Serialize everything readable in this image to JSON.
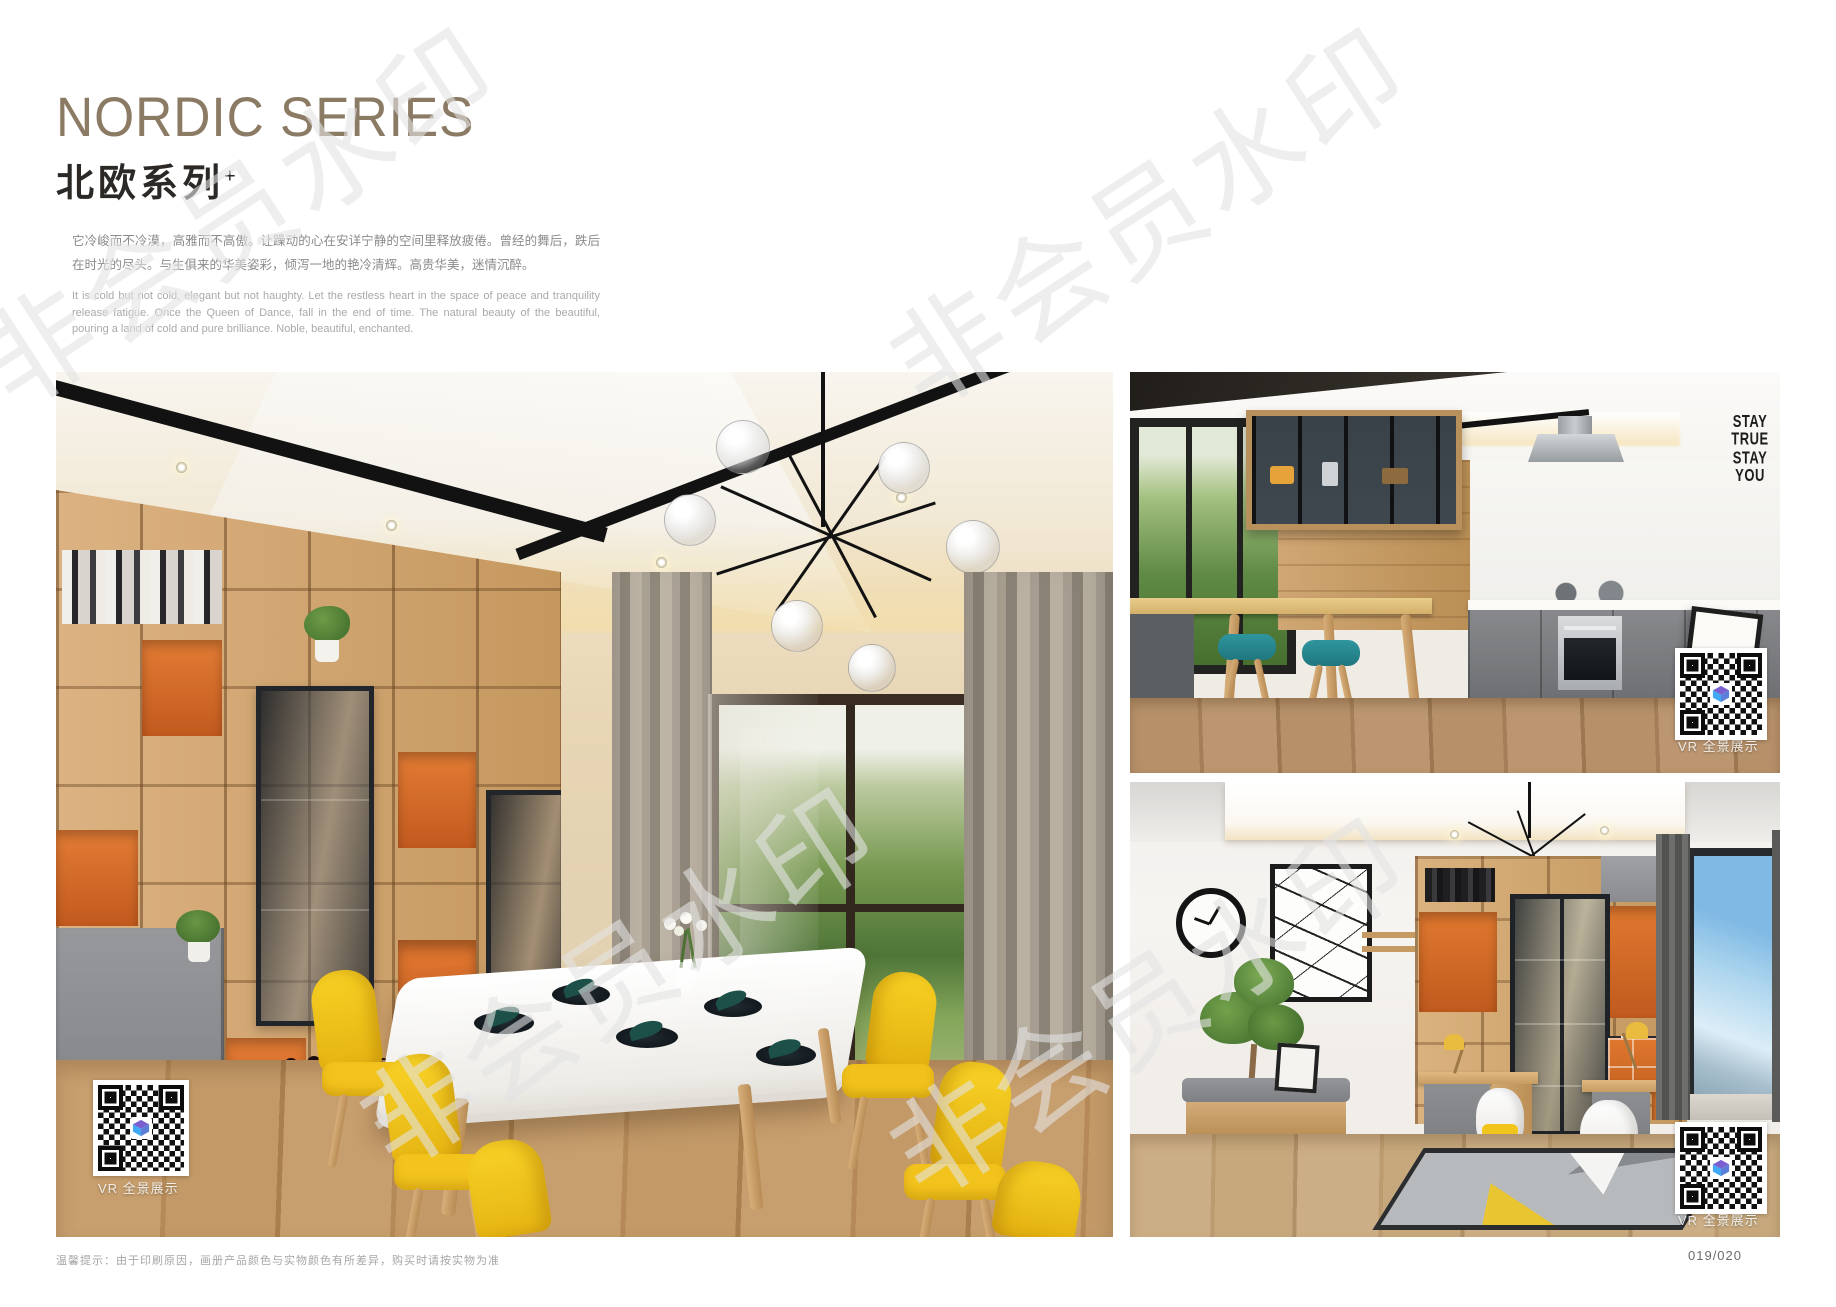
{
  "header": {
    "title_en": "NORDIC SERIES",
    "title_zh": "北欧系列",
    "title_sup": "+",
    "desc_zh": "它冷峻而不冷漠，高雅而不高傲。让躁动的心在安详宁静的空间里释放疲倦。曾经的舞后，跌后在时光的尽头。与生俱来的华美姿彩，倾泻一地的艳冷清辉。高贵华美，迷情沉醉。",
    "desc_en": "It is cold but not cold, elegant but not haughty. Let the restless heart in the space of peace and tranquility release fatigue. Once the Queen of Dance, fall in the end of time. The natural beauty of the beautiful, pouring a land of cold and pure brilliance. Noble, beautiful, enchanted.",
    "title_color": "#8c7b64"
  },
  "watermark": {
    "text": "非会员水印"
  },
  "photos": {
    "dining": {
      "name": "dining-room",
      "vr_label": "VR 全景展示"
    },
    "kitchen": {
      "name": "kitchen",
      "vr_label": "VR 全景展示",
      "wall_text": "STAY\nTRUE\nSTAY\nYOU"
    },
    "study": {
      "name": "study-room",
      "vr_label": "VR 全景展示"
    }
  },
  "footer": {
    "disclaimer": "温馨提示：由于印刷原因，画册产品颜色与实物颜色有所差异，购买时请按实物为准",
    "page_number": "019/020"
  },
  "colors": {
    "accent_orange": "#dd6f2e",
    "wood": "#cfa672",
    "chair_yellow": "#f2c51c",
    "stool_teal": "#2a8d96",
    "qr_logo_purple": "#7a5fd0",
    "qr_logo_blue": "#3fa9f5"
  }
}
